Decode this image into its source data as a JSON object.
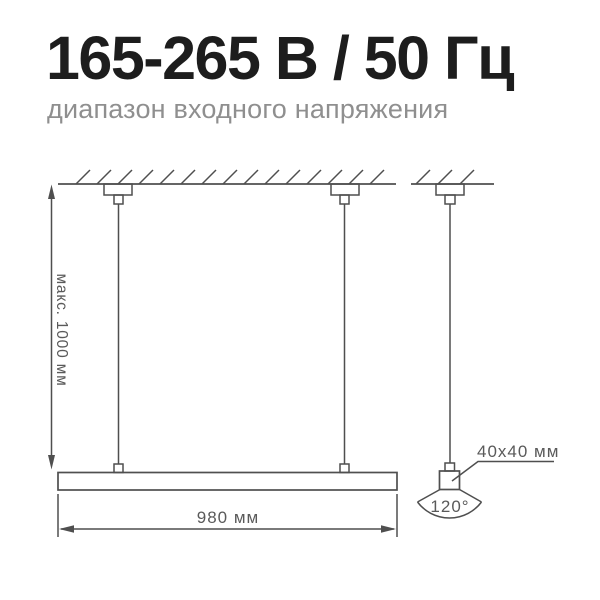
{
  "header": {
    "title": "165-265 В / 50 Гц",
    "subtitle": "диапазон входного напряжения"
  },
  "diagram": {
    "max_height_label": "макс. 1000 мм",
    "length_label": "980 мм",
    "profile_label": "40x40 мм",
    "beam_angle_label": "120°"
  },
  "colors": {
    "title": "#1d1d1d",
    "subtitle": "#8f8f8f",
    "line": "#4f4f4f",
    "dim_text": "#5a5a5a"
  }
}
